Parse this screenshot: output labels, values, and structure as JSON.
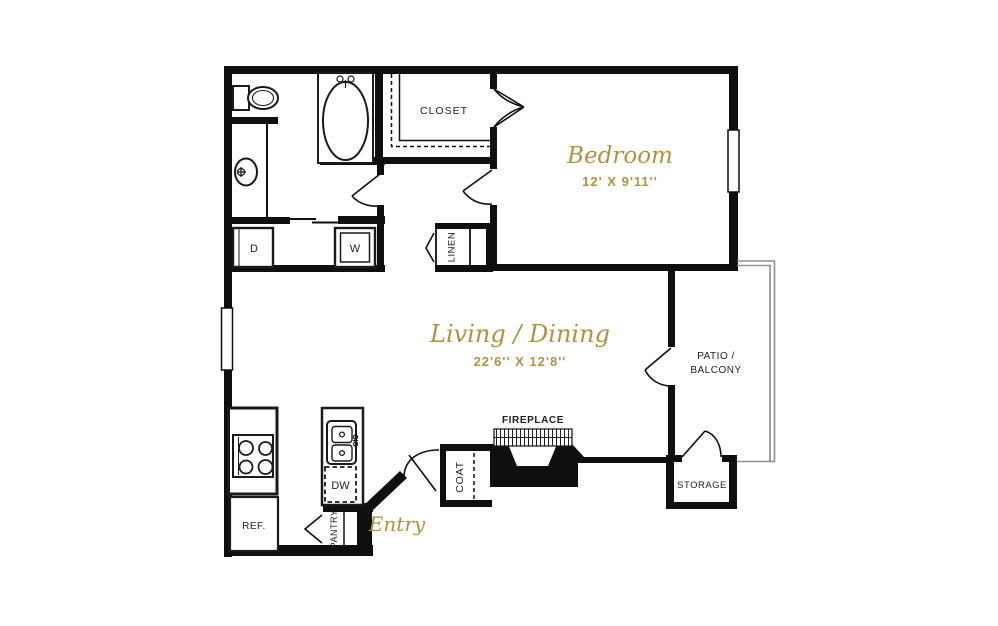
{
  "plan_title": "One bedroom apartment floor plan",
  "colors": {
    "wall": "#0f0f0f",
    "accent_gold": "#b2913f",
    "label_text": "#1f1f1f",
    "patio_rail_gray": "#8f8f8f",
    "background": "#ffffff"
  },
  "rooms": {
    "bedroom": {
      "name": "Bedroom",
      "dims": "12' X 9'11''"
    },
    "living": {
      "name": "Living / Dining",
      "dims": "22'6'' X 12'8''"
    },
    "entry": {
      "name": "Entry"
    },
    "closet": {
      "label": "CLOSET"
    },
    "linen": {
      "label": "LINEN"
    },
    "coat": {
      "label": "COAT"
    },
    "pantry": {
      "label": "PANTRY"
    },
    "storage": {
      "label": "STORAGE"
    },
    "patio": {
      "line1": "PATIO /",
      "line2": "BALCONY"
    }
  },
  "fixtures": {
    "fireplace": {
      "label": "FIREPLACE"
    },
    "dryer": {
      "label": "D"
    },
    "washer": {
      "label": "W"
    },
    "dishwasher": {
      "label": "DW"
    },
    "refrigerator": {
      "label": "REF."
    }
  }
}
